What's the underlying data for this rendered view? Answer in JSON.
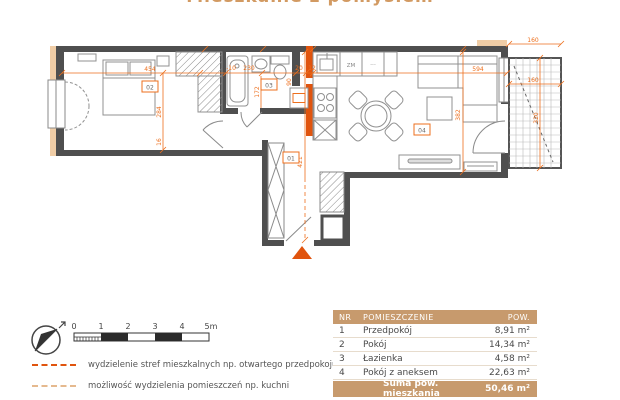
{
  "title": {
    "partial": "Mieszkanie z pomysłem"
  },
  "plan": {
    "rooms": {
      "r01": "01",
      "r02": "02",
      "r03": "03",
      "r04": "04"
    },
    "kitchen": {
      "zm": "ZM",
      "dots": "···"
    },
    "dims": {
      "w454": "454",
      "h284": "284",
      "h16": "16",
      "wm10": "-10",
      "w230": "230",
      "h172": "172",
      "h90": "90",
      "w20": "20",
      "w12": "12",
      "w594": "594",
      "h382": "382",
      "h421": "421",
      "bal_w": "160",
      "bal_w2": "160",
      "bal_h": "320"
    },
    "colors": {
      "wall": "#4f4f4f",
      "dimension": "#ed6f1d",
      "accent_wall": "#e0540e",
      "tan": "#f0cda6"
    }
  },
  "legend": {
    "scale": {
      "ticks": [
        "0",
        "1",
        "2",
        "3",
        "4",
        "5m"
      ]
    },
    "items": [
      {
        "label": "wydzielenie stref mieszkalnych np. otwartego przedpokoju"
      },
      {
        "label": "możliwość wydzielenia pomieszczeń np. kuchni"
      }
    ]
  },
  "table": {
    "headers": [
      "NR",
      "POMIESZCZENIE",
      "POW."
    ],
    "rows": [
      {
        "nr": "1",
        "name": "Przedpokój",
        "area": "8,91 m²"
      },
      {
        "nr": "2",
        "name": "Pokój",
        "area": "14,34 m²"
      },
      {
        "nr": "3",
        "name": "Łazienka",
        "area": "4,58 m²"
      },
      {
        "nr": "4",
        "name": "Pokój z aneksem",
        "area": "22,63 m²"
      }
    ],
    "footer": {
      "label": "Suma pow. mieszkania",
      "value": "50,46 m²"
    }
  }
}
